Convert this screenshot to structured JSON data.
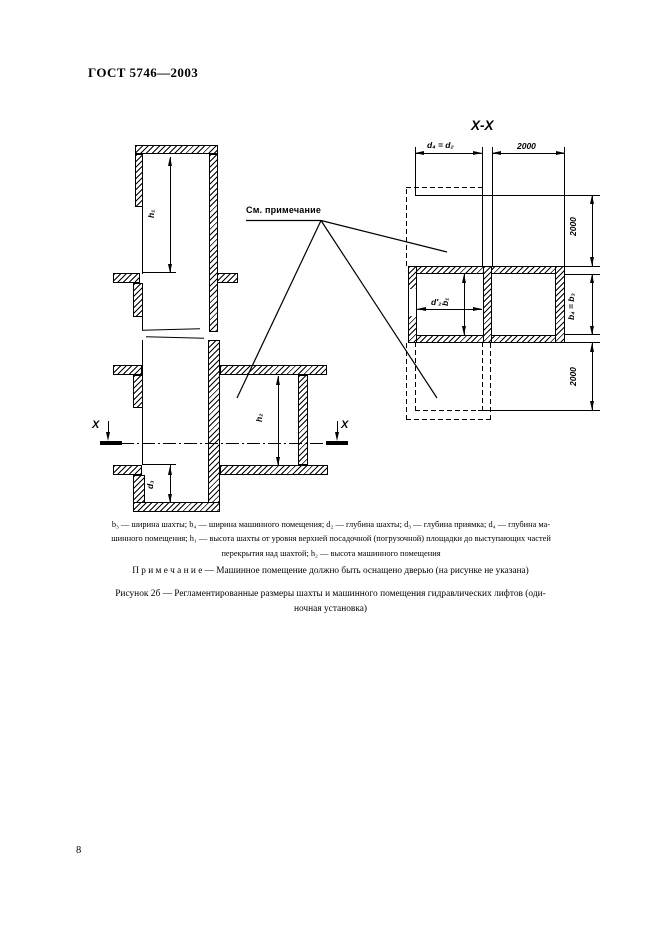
{
  "header": {
    "standard": "ГОСТ 5746—2003"
  },
  "figure": {
    "see_note": "См. примечание",
    "section_view": {
      "shaft_height": "h₁",
      "machine_room_height": "h₂",
      "pit_depth": "d₃",
      "cut_mark_left": "X",
      "cut_mark_right": "X"
    },
    "plan_view": {
      "title": "X-X",
      "machine_depth_eq": "d₄ = d₂",
      "top_clearance": "2000",
      "right_upper_clearance": "2000",
      "width_eq": "b₄ = b₃",
      "right_lower_clearance": "2000",
      "inner_depth": "d′₂",
      "inner_width": "b₁"
    }
  },
  "legend": {
    "line1": "b₃ — ширина шахты; b₄ — ширина машинного помещения; d₂ — глубина шахты; d₃ — глубина приямка; d₄ — глубина ма-",
    "line2": "шинного помещения; h₁ — высота шахты от уровня верхней посадочной (погрузочной) площадки до выступающих частей",
    "line3": "перекрытия над шахтой; h₂ — высота машинного помещения"
  },
  "note": "П р и м е ч а н и е — Машинное помещение должно быть оснащено дверью (на рисунке не указана)",
  "caption": {
    "line1": "Рисунок 2б — Регламентированные размеры шахты и машинного помещения гидравлических лифтов (оди-",
    "line2": "ночная установка)"
  },
  "footer": {
    "page_number": "8"
  }
}
